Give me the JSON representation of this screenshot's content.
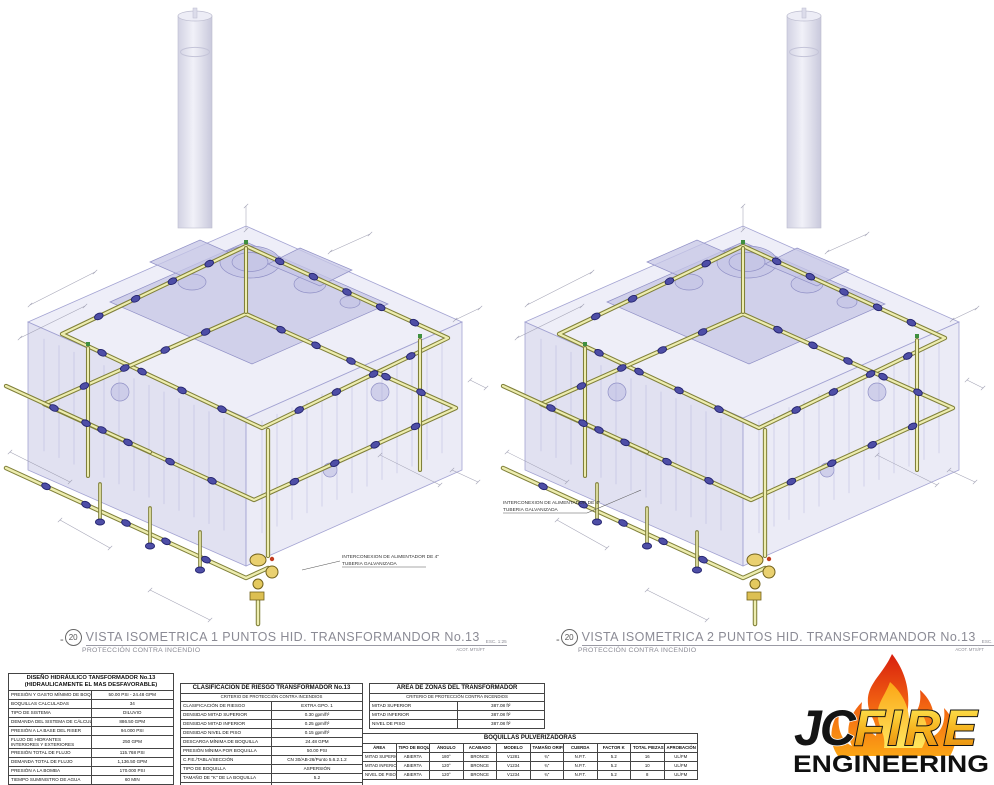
{
  "drawings": {
    "left": {
      "callout_number": "20",
      "title": "VISTA ISOMETRICA 1 PUNTOS HID. TRANSFORMANDOR No.13",
      "scale": "ESC. 1:25",
      "subtitle": "PROTECCIÓN CONTRA INCENDIO",
      "units": "ACOT. MTS/FT",
      "note_line1": "INTERCONEXION DE ALIMENTADOR DE 4\"",
      "note_line2": "TUBERIA GALVANIZADA"
    },
    "right": {
      "callout_number": "20",
      "title": "VISTA ISOMETRICA 2 PUNTOS HID. TRANSFORMANDOR No.13",
      "scale": "ESC. 1:25",
      "subtitle": "PROTECCIÓN CONTRA INCENDIO",
      "units": "ACOT. MTS/FT",
      "note_line1": "INTERCONEXION DE ALIMENTADOR DE 4\"",
      "note_line2": "TUBERIA GALVANIZADA"
    }
  },
  "tables": {
    "hydraulic": {
      "title_line1": "DISEÑO HIDRÁULICO TANSFORMADOR No.13",
      "title_line2": "(HIDRAULICAMENTE EL MAS DESFAVORABLE)",
      "rows": [
        {
          "label": "PRESIÓN Y GASTO MÍNIMO DE BOQUILLA",
          "value": "50.00 PSI - 24.48 GPM"
        },
        {
          "label": "BOQUILLAS CALCULADAS",
          "value": "34"
        },
        {
          "label": "TIPO DE SISTEMA",
          "value": "DILUVIO"
        },
        {
          "label": "DEMANDA DEL SISTEMA DE CÁLCULO",
          "value": "886.50 GPM"
        },
        {
          "label": "PRESIÓN A LA BASE DEL RISER",
          "value": "94.000 PSI"
        },
        {
          "label": "FLUJO DE HIDRANTES INTERIORES Y EXTERIORES",
          "value": "250 GPM"
        },
        {
          "label": "PRESIÓN TOTAL DE FLUJO",
          "value": "115.768 PSI"
        },
        {
          "label": "DEMANDA TOTAL DE FLUJO",
          "value": "1,136.50 GPM"
        },
        {
          "label": "PRESIÓN A LA BOMBA",
          "value": "170.000 PSI"
        },
        {
          "label": "TIEMPO SUMINISTRO DE AGUA",
          "value": "60 MIN"
        },
        {
          "label": "DEMANDA DE AGUA CONTRAINCENDIO",
          "value": "68,190.00 GAL"
        }
      ]
    },
    "risk": {
      "title": "CLASIFICACIÓN DE RIESGO TRANSFORMADOR No.13",
      "subtitle": "CRITERIO DE PROTECCIÓN CONTRA INCENDIOS",
      "rows": [
        {
          "label": "CLASIFICACIÓN DE RIESGO",
          "value": "EXTRA GPO. 1"
        },
        {
          "label": "DENSIDAD MITAD SUPERIOR",
          "value": "0.30 gpm/ft²"
        },
        {
          "label": "DENSIDAD MITAD INFERIOR",
          "value": "0.25 gpm/ft²"
        },
        {
          "label": "DENSIDAD NIVEL DE PISO",
          "value": "0.15 gpm/ft²"
        },
        {
          "label": "DESCARGA MÍNIMA DE BOQUILLA",
          "value": "24.48 GPM"
        },
        {
          "label": "PRESIÓN MÍNIMA POR BOQUILLA",
          "value": "50.00 PSI"
        },
        {
          "label": "C.P.E./TABLA/SECCIÓN",
          "value": "CN 30/AB-26/Punto 5.6.2.1.2"
        },
        {
          "label": "TIPO DE BOQUILLA",
          "value": "ASPERSIÓN"
        },
        {
          "label": "TAMAÑO DE \"K\" DE LA BOQUILLA",
          "value": "5.2"
        },
        {
          "label": "MANGUERAS EXTERIORES",
          "value": "250 GPM"
        }
      ]
    },
    "areas": {
      "title": "ÁREA DE ZONAS DEL TRANSFORMADOR",
      "subtitle": "CRITERIO DE PROTECCIÓN CONTRA INCENDIOS",
      "rows": [
        {
          "label": "MITAD SUPERIOR",
          "value": "387.08 ft²"
        },
        {
          "label": "MITAD INFERIOR",
          "value": "387.08 ft²"
        },
        {
          "label": "NIVEL DE PISO",
          "value": "387.08 ft²"
        }
      ]
    },
    "nozzles": {
      "title": "BOQUILLAS PULVERIZADORAS",
      "columns": [
        "ÁREA",
        "TIPO DE BOQUILLA",
        "ÁNGULO",
        "ACABADO",
        "MODELO",
        "TAMAÑO ORIFICIO",
        "CUERDA",
        "FACTOR K",
        "TOTAL PIEZAS",
        "APROBACIÓN"
      ],
      "rows": [
        [
          "MITAD SUPERIOR",
          "ABIERTA",
          "180°",
          "BRONCE",
          "V1281",
          "¾\"",
          "N.P.T.",
          "5.2",
          "16",
          "UL/FM"
        ],
        [
          "MITAD INFERIOR",
          "ABIERTA",
          "120°",
          "BRONCE",
          "V1234",
          "¾\"",
          "N.P.T.",
          "5.2",
          "10",
          "UL/FM"
        ],
        [
          "NIVEL DE PISO",
          "ABIERTA",
          "120°",
          "BRONCE",
          "V1234",
          "¾\"",
          "N.P.T.",
          "5.2",
          "8",
          "UL/FM"
        ]
      ]
    }
  },
  "logo": {
    "jc": "JC",
    "fire": "FIRE",
    "engineering": "ENGINEERING"
  },
  "colors": {
    "pipe_outline": "#80803a",
    "pipe_fill": "#ededaf",
    "nozzle_blue": "#4e4ea6",
    "mass_lavender": "#cdcde8",
    "flame_red": "#d81f0e",
    "flame_orange": "#f46a12",
    "flame_yellow": "#ffd84a"
  }
}
